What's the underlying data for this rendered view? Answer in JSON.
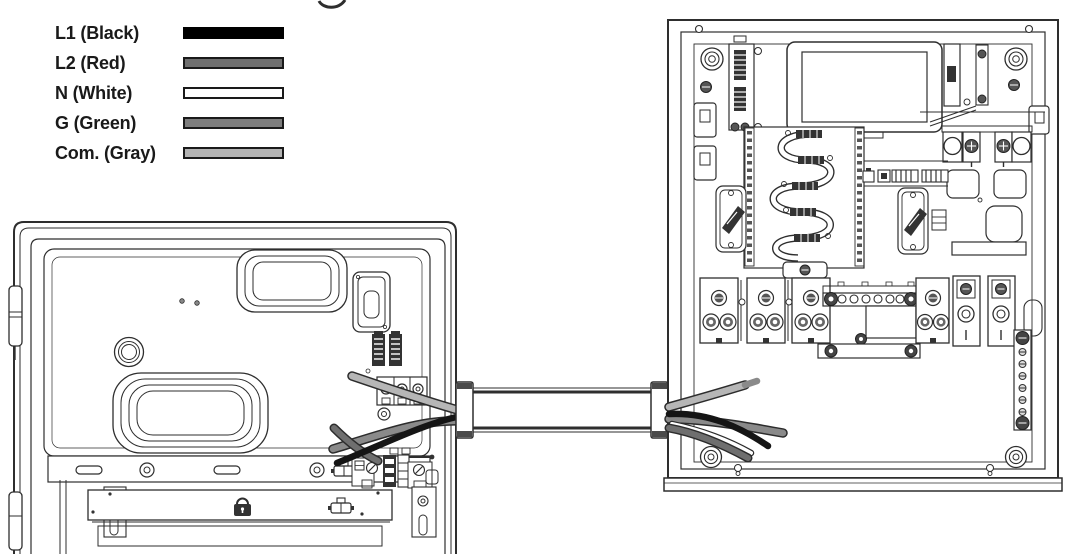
{
  "page": {
    "cropped_title_fragment": "g"
  },
  "legend": {
    "items": [
      {
        "label": "L1 (Black)",
        "fill": "#000000",
        "border": "#000000"
      },
      {
        "label": "L2 (Red)",
        "fill": "#6f6f6f",
        "border": "#1a1a1a"
      },
      {
        "label": "N (White)",
        "fill": "#ffffff",
        "border": "#1a1a1a"
      },
      {
        "label": "G (Green)",
        "fill": "#7d7d7d",
        "border": "#1a1a1a"
      },
      {
        "label": "Com. (Gray)",
        "fill": "#b3b3b3",
        "border": "#1a1a1a"
      }
    ]
  },
  "diagram": {
    "line_color": "#2e2e2e",
    "wire_colors": {
      "l1_black": "#151515",
      "l2_red_gray": "#6f6f6f",
      "n_white": "#ffffff",
      "g_green_gray": "#8a8a8a",
      "com_gray": "#b6b6b6",
      "com_tip": "#8a8a8a"
    },
    "left_enclosure_wires": [
      "com",
      "g",
      "l2",
      "l1"
    ],
    "right_enclosure_wires": [
      "com",
      "g",
      "n",
      "l2",
      "l1"
    ],
    "icons": [
      "padlock-icon",
      "connector-plug-icon"
    ],
    "bus_bar_hole_count": 6,
    "ground_bar_screw_count": 6
  }
}
